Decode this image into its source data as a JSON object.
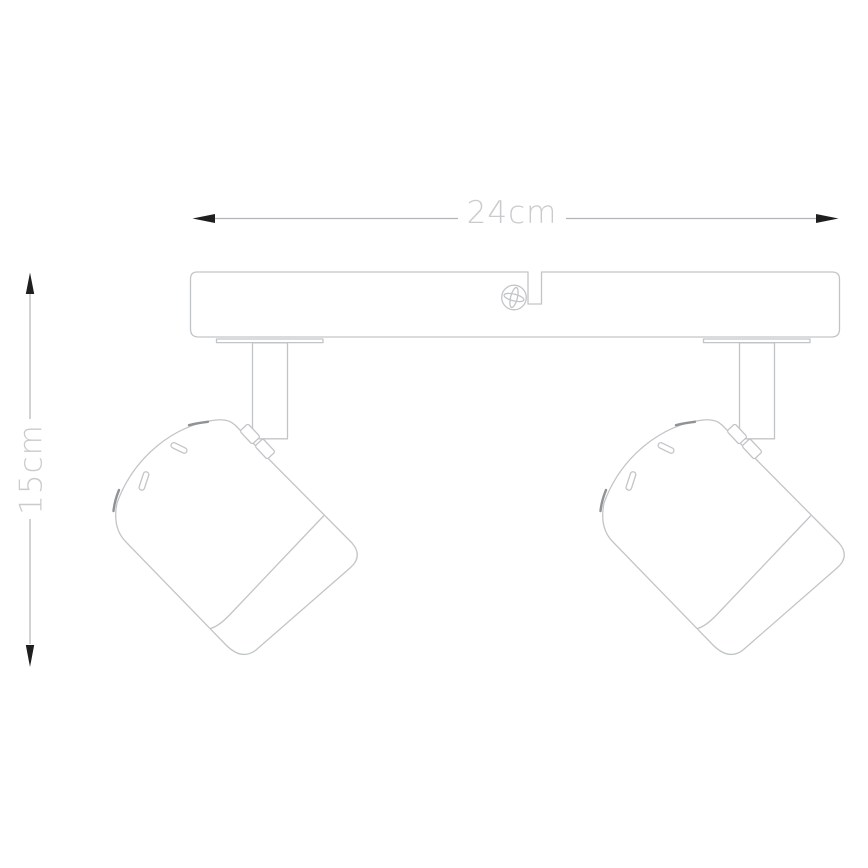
{
  "dimensions": {
    "width": {
      "label": "24cm",
      "value": 24,
      "unit": "cm"
    },
    "height": {
      "label": "15cm",
      "value": 15,
      "unit": "cm"
    }
  },
  "colors": {
    "background": "#ffffff",
    "outline": "#c2c5c7",
    "outline-dark": "#8f9396",
    "dimension-line": "#b2b5b7",
    "arrow": "#1f1f1f",
    "label-text": "#c9cbcd"
  }
}
